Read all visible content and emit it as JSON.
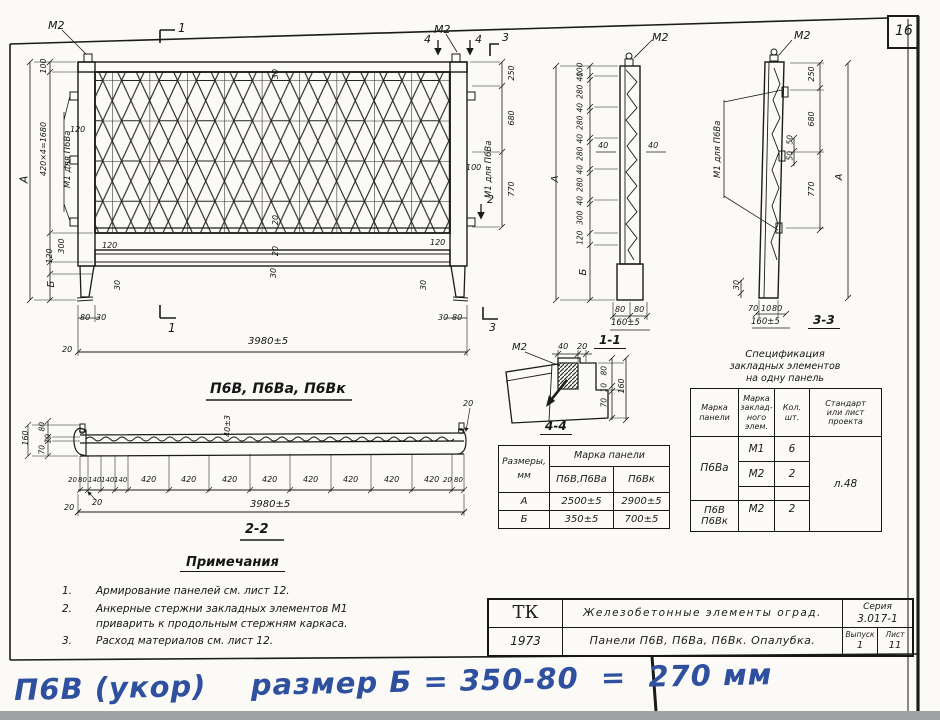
{
  "sheet": {
    "number": "16"
  },
  "front": {
    "m2_left": "М2",
    "m2_right": "М2",
    "embed_label": "М1 для П6Ва",
    "cuts": {
      "c1t": "1",
      "c1b": "1",
      "c2": "2",
      "c3t": "3",
      "c3b": "3",
      "c4l": "4",
      "c4r": "4"
    },
    "dims": {
      "a": "А",
      "h100": "100",
      "h1680": "420×4=1680",
      "h300": "300",
      "h120": "120",
      "b": "Б",
      "e120": "120",
      "r250": "250",
      "r680": "680",
      "r770": "770",
      "r100": "100",
      "w80l": "80",
      "w30l": "30",
      "w30r": "30",
      "w80r": "80",
      "w20": "20",
      "total": "3980±5",
      "i30t": "30",
      "i20a": "20",
      "i20b": "20",
      "i30b": "30",
      "i120l": "120",
      "i120r": "120",
      "f30l": "30",
      "f30r": "30"
    }
  },
  "s11": {
    "caption": "1-1",
    "m2": "М2",
    "a": "А",
    "b": "Б",
    "chain": [
      "100",
      "40",
      "280",
      "40",
      "280",
      "40",
      "280",
      "40",
      "280",
      "40",
      "300",
      "120"
    ],
    "mid_l": "40",
    "mid_r": "40",
    "b80l": "80",
    "b80r": "80",
    "btot": "160±5"
  },
  "s33": {
    "caption": "3-3",
    "m2": "М2",
    "embed_label": "М1 для П6Ва",
    "a": "А",
    "d250": "250",
    "d680": "680",
    "d770": "770",
    "d50a": "50",
    "d50b": "50",
    "d30": "30",
    "b70": "70",
    "b10": "10",
    "b80": "80",
    "btot": "160±5"
  },
  "d44": {
    "caption": "4-4",
    "m2": "М2",
    "t40": "40",
    "t20": "20",
    "r80": "80",
    "r10": "10",
    "r70": "70",
    "rtot": "160"
  },
  "panel_title": "П6В,  П6Ва, П6Вк",
  "s22": {
    "caption": "2-2",
    "l160": "160",
    "l80": "80",
    "l10": "10",
    "l70": "70",
    "v40": "40±3",
    "t20": "20",
    "c20": "20",
    "b20": "20",
    "total": "3980±5",
    "chain": [
      "20",
      "80",
      "140",
      "140",
      "140",
      "420",
      "420",
      "420",
      "420",
      "420",
      "420",
      "420",
      "420",
      "20",
      "80"
    ]
  },
  "size_table": {
    "c0a": "Размеры,",
    "c0b": "мм",
    "group": "Марка панели",
    "m1": "П6В,П6Ва",
    "m2": "П6Вк",
    "r1n": "А",
    "r1v1": "2500±5",
    "r1v2": "2900±5",
    "r2n": "Б",
    "r2v1": "350±5",
    "r2v2": "700±5"
  },
  "spec_table": {
    "t1": "Спецификация",
    "t2": "закладных элементов",
    "t3": "на одну панель",
    "h1a": "Марка",
    "h1b": "панели",
    "h2a": "Марка",
    "h2b": "заклад-",
    "h2c": "ного",
    "h2d": "элем.",
    "h3a": "Кол.",
    "h3b": "шт.",
    "h4a": "Стандарт",
    "h4b": "или лист",
    "h4c": "проекта",
    "g1": "П6Ва",
    "g1r1m": "М1",
    "g1r1q": "6",
    "g1r2m": "М2",
    "g1r2q": "2",
    "g2a": "П6В",
    "g2b": "П6Вк",
    "g2r1m": "М2",
    "g2r1q": "2",
    "std": "л.48"
  },
  "notes": {
    "title": "Примечания",
    "n1": "1.",
    "t1": "Армирование панелей см. лист 12.",
    "n2": "2.",
    "t2a": "Анкерные стержни закладных элементов М1",
    "t2b": "приварить к продольным стержням каркаса.",
    "n3": "3.",
    "t3": "Расход материалов см. лист 12."
  },
  "title_block": {
    "org": "ТК",
    "year": "1973",
    "row1": "Железобетонные элементы оград.",
    "row2": "Панели П6В, П6Ва, П6Вк. Опалубка.",
    "series_label": "Серия",
    "series": "3.017-1",
    "issue_label": "Выпуск",
    "issue": "1",
    "sheet_label": "Лист",
    "sheet": "11"
  },
  "handwriting": {
    "text": "П6В (укор)    размер Б = 350-80  =  270 мм"
  }
}
